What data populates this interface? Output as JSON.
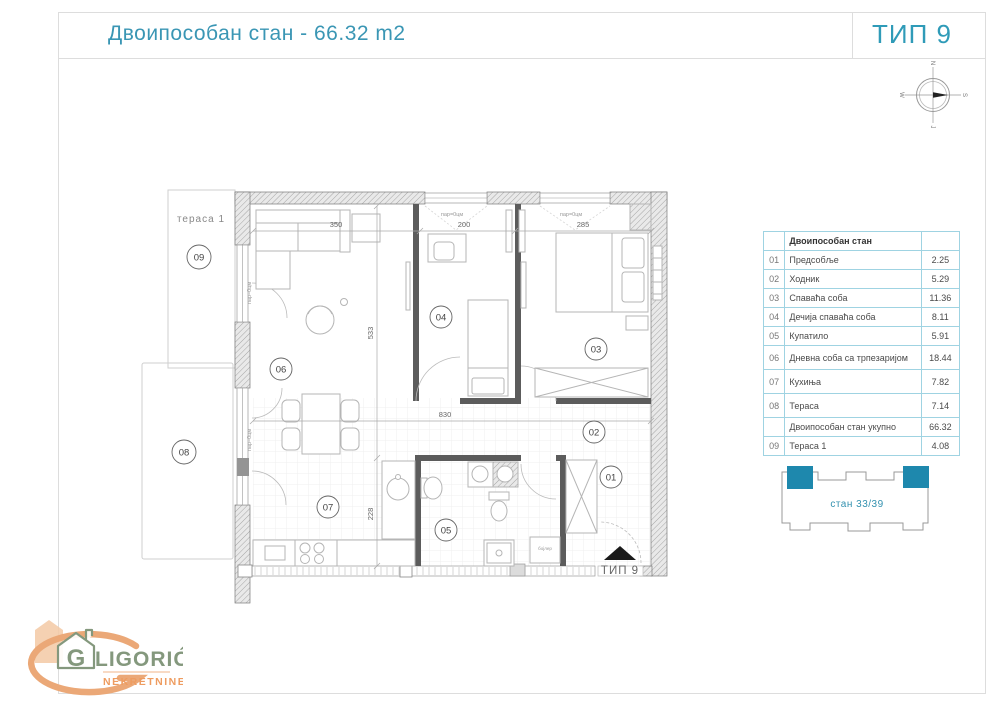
{
  "header": {
    "title": "Двоипособан стан - 66.32 m2",
    "type_label": "ТИП 9"
  },
  "compass": {
    "top": "N",
    "right": "S",
    "left": "W",
    "bottom": "J"
  },
  "area_table": {
    "header": "Двоипособан стан",
    "rows": [
      {
        "num": "01",
        "name": "Предсобље",
        "area": "2.25"
      },
      {
        "num": "02",
        "name": "Ходник",
        "area": "5.29"
      },
      {
        "num": "03",
        "name": "Спаваћа соба",
        "area": "11.36"
      },
      {
        "num": "04",
        "name": "Дечија спаваћа соба",
        "area": "8.11"
      },
      {
        "num": "05",
        "name": "Купатило",
        "area": "5.91"
      },
      {
        "num": "06",
        "name": "Дневна соба са трпезаријом",
        "area": "18.44"
      },
      {
        "num": "07",
        "name": "Кухиња",
        "area": "7.82"
      },
      {
        "num": "08",
        "name": "Тераса",
        "area": "7.14"
      },
      {
        "num": "",
        "name": "Двоипособан стан укупно",
        "area": "66.32"
      },
      {
        "num": "09",
        "name": "Тераса 1",
        "area": "4.08"
      }
    ]
  },
  "plan": {
    "markers": {
      "m01": "01",
      "m02": "02",
      "m03": "03",
      "m04": "04",
      "m05": "05",
      "m06": "06",
      "m07": "07",
      "m08": "08",
      "m09": "09"
    },
    "dims": {
      "w_living": "350",
      "w_kids": "200",
      "w_bedroom": "285",
      "h_living": "533",
      "h_kitchen": "228",
      "w_total": "830"
    },
    "labels": {
      "terrace1": "тераса 1",
      "parapet": "пар=0цм",
      "boiler": "бојлер",
      "entrance_type": "ТИП 9"
    }
  },
  "building_diagram": {
    "caption": "стан 33/39"
  },
  "logo": {
    "initial": "G",
    "name_rest": "LIGORIĆ",
    "subtitle": "NEKRETNINE"
  },
  "colors": {
    "accent_teal": "#3a96b4",
    "table_border": "#9fd3e2",
    "building_fill": "#1e88ad",
    "logo_green": "#84987d",
    "logo_orange": "#ee9c60"
  }
}
